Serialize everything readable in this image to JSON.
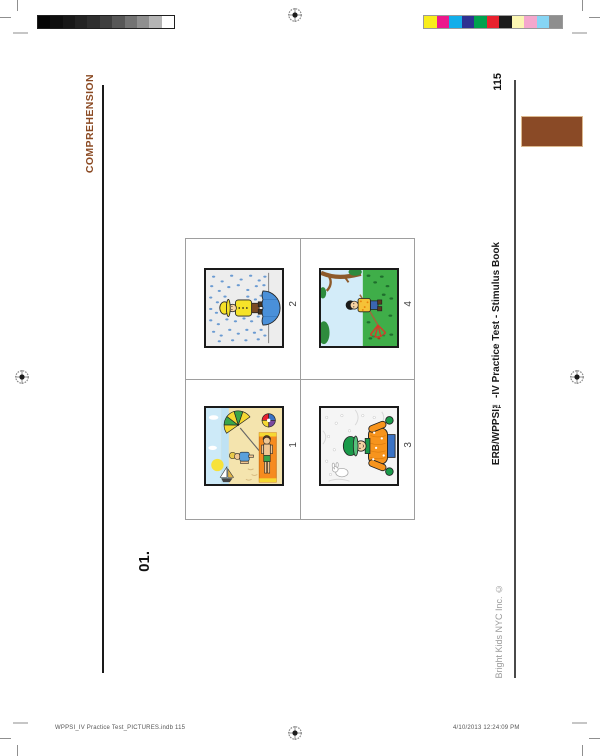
{
  "page": {
    "section_label": "COMPREHENSION",
    "page_number": "115",
    "item_number": "01.",
    "book_title": "ERB/WPPSI™-IV Practice Test - Stimulus Book",
    "publisher": "Bright Kids NYC Inc. ©",
    "tab_color": "#8a4a26",
    "section_label_color": "#8b4a23"
  },
  "footer": {
    "file_info": "WPPSI_IV Practice Test_PICTURES.indb   115",
    "timestamp": "4/10/2013   12:24:09 PM"
  },
  "grid": {
    "cells": [
      {
        "label": "2",
        "scene": "child in yellow raincoat with blue umbrella in the rain"
      },
      {
        "label": "4",
        "scene": "child raking autumn leaves under a tree"
      },
      {
        "label": "1",
        "scene": "children playing at the beach with umbrella and ball"
      },
      {
        "label": "3",
        "scene": "child in orange winter coat in the snow"
      }
    ]
  },
  "print_marks": {
    "grayscale_bar": [
      "#050505",
      "#0f0f0f",
      "#181818",
      "#232323",
      "#2e2e2e",
      "#3f3f3f",
      "#575757",
      "#737373",
      "#8f8f8f",
      "#b5b5b5",
      "#ffffff"
    ],
    "color_bar": [
      "#f9ed1b",
      "#ec188c",
      "#12aeea",
      "#2e3192",
      "#00a14e",
      "#e8212e",
      "#1b1b1b",
      "#fbf6b2",
      "#f4a7cd",
      "#86d5f4",
      "#8e8e8e"
    ],
    "registration_marks": [
      "top-center",
      "left-middle",
      "right-middle",
      "bottom-center"
    ]
  }
}
